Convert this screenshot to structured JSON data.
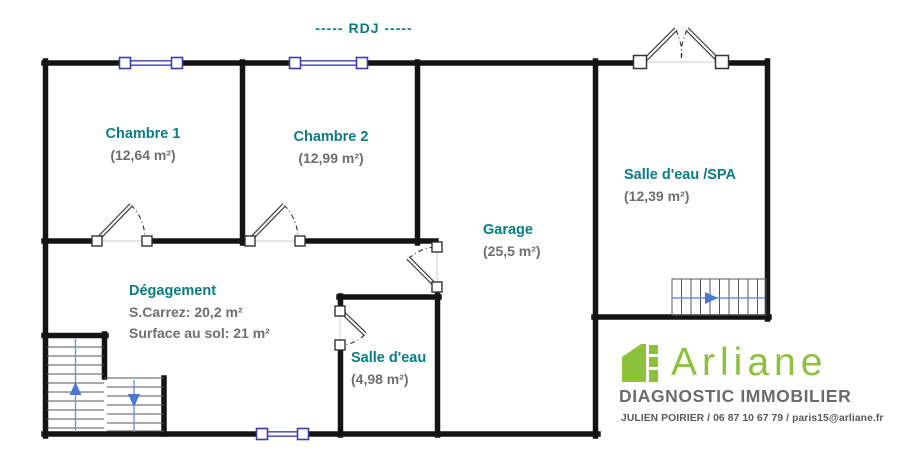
{
  "title": {
    "text": "-----  RDJ  -----"
  },
  "rooms": {
    "chambre1": {
      "name": "Chambre 1",
      "area": "(12,64 m²)"
    },
    "chambre2": {
      "name": "Chambre 2",
      "area": "(12,99 m²)"
    },
    "spa": {
      "name": "Salle d'eau /SPA",
      "area": "(12,39 m²)"
    },
    "garage": {
      "name": "Garage",
      "area": "(25,5 m²)"
    },
    "degagement": {
      "name": "Dégagement",
      "carrez": "S.Carrez: 20,2 m²",
      "surface": "Surface au sol: 21 m²"
    },
    "salle_eau": {
      "name": "Salle d'eau",
      "area": "(4,98 m²)"
    }
  },
  "logo": {
    "brand": "Arliane",
    "tagline": "DIAGNOSTIC IMMOBILIER",
    "contact": "JULIEN POIRIER / 06 87 10 67 79 / paris15@arliane.fr"
  },
  "colors": {
    "room_label_teal": "#0a7c84",
    "area_gray": "#6e6e6e",
    "wall_black": "#141414",
    "window_indigo": "#5b5bc6",
    "stair_arrow_blue": "#4a79cf",
    "logo_green": "#8dc13c",
    "logo_gray": "#6a6b6d"
  }
}
